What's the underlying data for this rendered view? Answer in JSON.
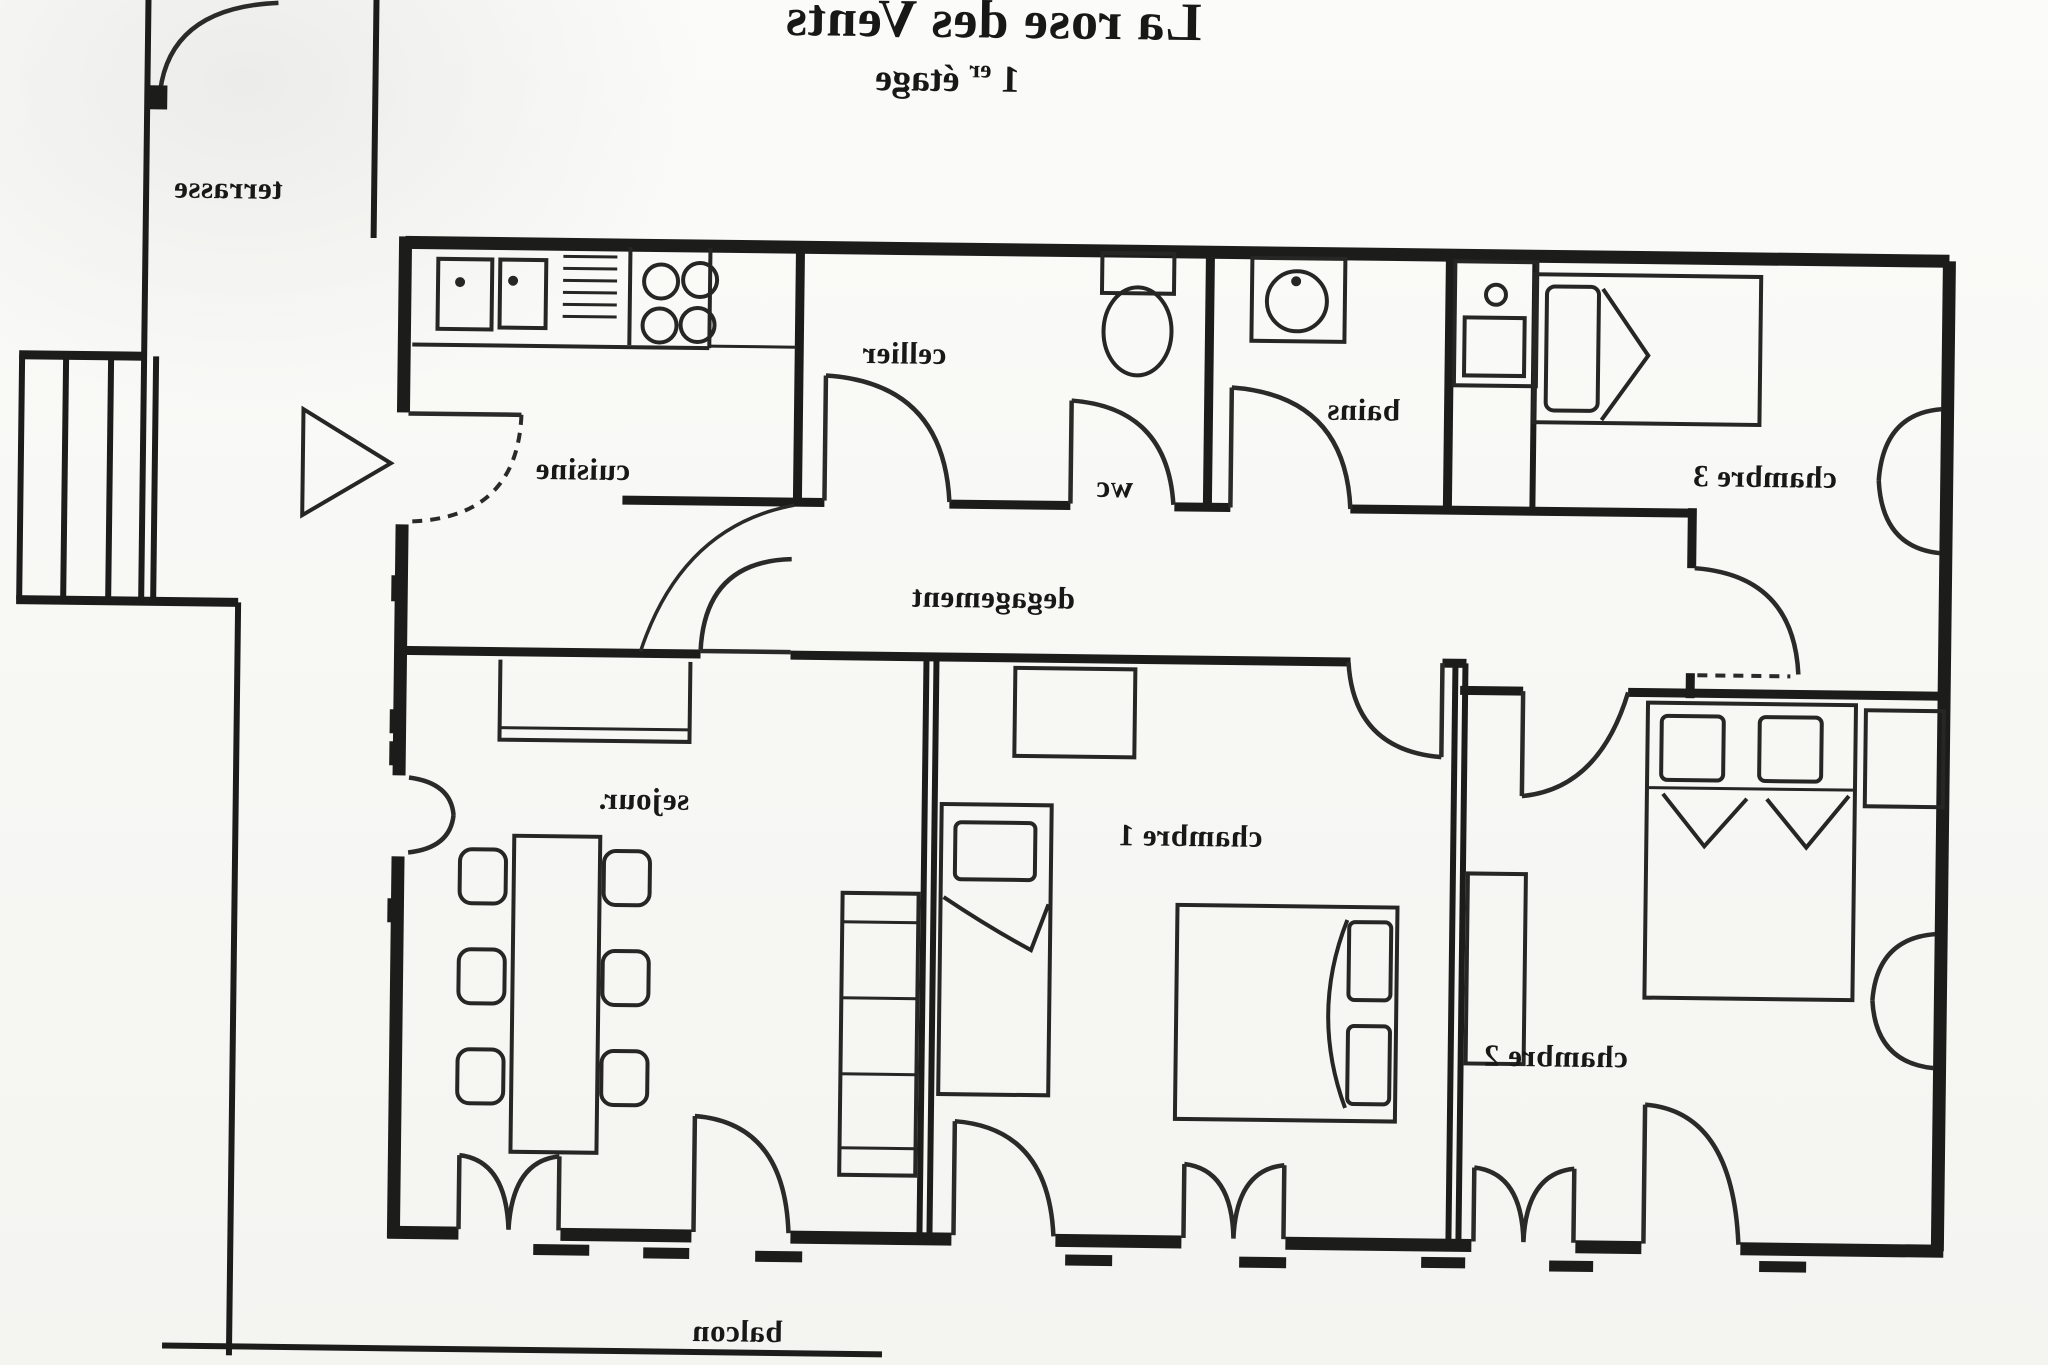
{
  "document": {
    "title": "La rose des Vents",
    "subtitle": {
      "num": "1",
      "sup": "er",
      "rest": " étage"
    },
    "orientation_note": "mirrored scan",
    "colors": {
      "paper": "#f7f7f4",
      "ink": "#1c1c1a"
    }
  },
  "rooms": {
    "terrasse": {
      "label": "terrasse"
    },
    "cuisine": {
      "label": "cuisine"
    },
    "cellier": {
      "label": "cellier"
    },
    "wc": {
      "label": "wc"
    },
    "bains": {
      "label": "bains"
    },
    "chambre3": {
      "label": "chambre 3"
    },
    "degagement": {
      "label": "degagement"
    },
    "sejour": {
      "label": "sejour."
    },
    "chambre1": {
      "label": "chambre 1"
    },
    "chambre2": {
      "label": "chambre 2"
    },
    "balcon": {
      "label": "balcon"
    }
  },
  "furniture": [
    "kitchen-double-sink",
    "kitchen-drainer",
    "kitchen-hob-4-burners",
    "toilet",
    "washbasin",
    "washing-machine",
    "single-bed-chambre3",
    "wardrobe-chambre1",
    "single-bed-chambre1",
    "double-bed-chambre1",
    "closet-chambre2",
    "double-bed-chambre2",
    "dresser-chambre2",
    "buffet-sejour",
    "dining-table",
    "six-chairs",
    "sofa",
    "stairs-terrasse",
    "direction-arrow"
  ]
}
